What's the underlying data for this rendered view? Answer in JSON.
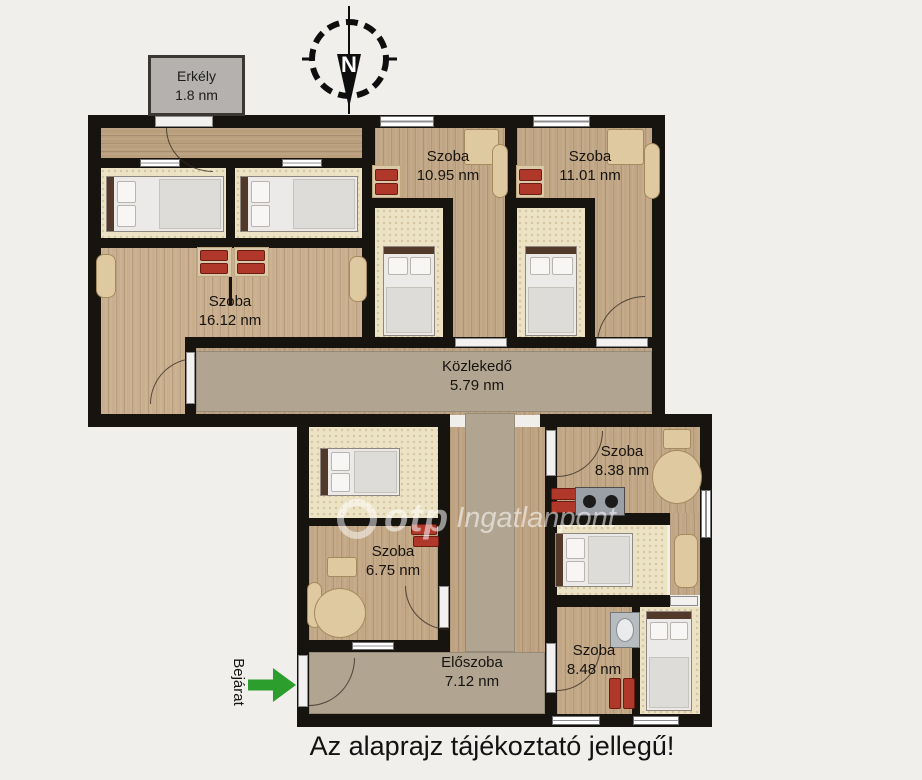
{
  "title_note": "Az alaprajz tájékoztató jellegű!",
  "compass": {
    "north_label": "N"
  },
  "entrance": {
    "label": "Bejárat"
  },
  "watermark": {
    "logo": "otp",
    "text": "Ingatlanpont"
  },
  "rooms": {
    "erkely": {
      "name": "Erkély",
      "area": "1.8 nm"
    },
    "szoba_1095": {
      "name": "Szoba",
      "area": "10.95 nm"
    },
    "szoba_1101": {
      "name": "Szoba",
      "area": "11.01 nm"
    },
    "szoba_1612": {
      "name": "Szoba",
      "area": "16.12 nm"
    },
    "kozlekedo": {
      "name": "Közlekedő",
      "area": "5.79 nm"
    },
    "szoba_838": {
      "name": "Szoba",
      "area": "8.38 nm"
    },
    "szoba_675": {
      "name": "Szoba",
      "area": "6.75 nm"
    },
    "szoba_848": {
      "name": "Szoba",
      "area": "8.48 nm"
    },
    "eloszoba": {
      "name": "Előszoba",
      "area": "7.12 nm"
    }
  },
  "colors": {
    "wall": "#17130f",
    "wood_floor": "#c3a886",
    "alcove_floor": "#ece2c4",
    "carpet": "#b1a591",
    "radiator_red": "#b0382a",
    "entrance_arrow_green": "#2b9e2e",
    "balcony_gray": "#b4b1ae"
  }
}
